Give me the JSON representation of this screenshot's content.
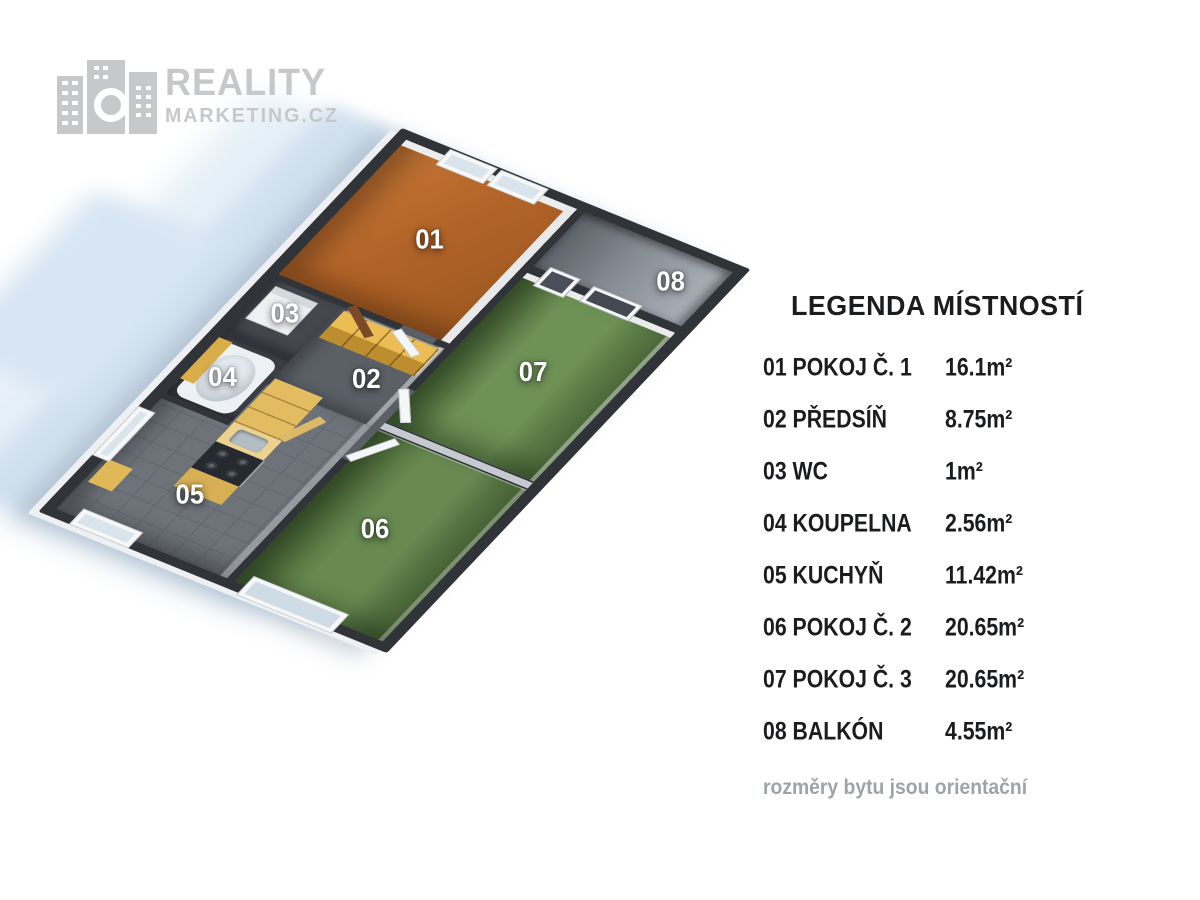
{
  "logo": {
    "line1": "REALITY",
    "line2": "MARKETING.CZ"
  },
  "legend": {
    "title": "LEGENDA MÍSTNOSTÍ",
    "rows": [
      {
        "label": "01 POKOJ Č. 1",
        "area": "16.1m²"
      },
      {
        "label": "02 PŘEDSÍŇ",
        "area": "8.75m²"
      },
      {
        "label": "03 WC",
        "area": "1m²"
      },
      {
        "label": "04 KOUPELNA",
        "area": "2.56m²"
      },
      {
        "label": "05 KUCHYŇ",
        "area": "11.42m²"
      },
      {
        "label": "06 POKOJ Č. 2",
        "area": "20.65m²"
      },
      {
        "label": "07 POKOJ Č. 3",
        "area": "20.65m²"
      },
      {
        "label": "08 BALKÓN",
        "area": "4.55m²"
      }
    ],
    "footnote": "rozměry bytu jsou orientační"
  },
  "floorplan": {
    "room_labels": [
      "01",
      "02",
      "03",
      "04",
      "05",
      "06",
      "07",
      "08"
    ]
  },
  "palette": {
    "room1_floor": "#b36428",
    "bedroom_floor": "#688a51",
    "hall_floor": "#5b6067",
    "wall_dark": "#303439",
    "furniture_mustard": "#ecbd55",
    "shadow_blue": "#d2e1ef",
    "logo_gray": "#c7c8ca",
    "legend_text": "#1b1c1e"
  }
}
